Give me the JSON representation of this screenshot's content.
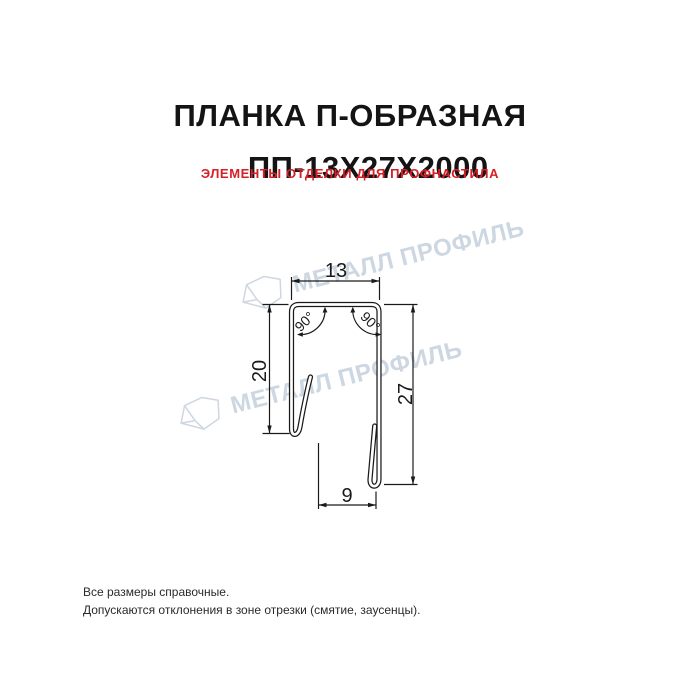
{
  "header": {
    "title_line1": "ПЛАНКА П-ОБРАЗНАЯ",
    "title_line2": "ПП-13Х27Х2000",
    "subtitle": "ЭЛЕМЕНТЫ ОТДЕЛКИ ДЛЯ ПРОФНАСТИЛА",
    "title_color": "#141414",
    "subtitle_color": "#d52027"
  },
  "watermark": {
    "text": "МЕТАЛЛ ПРОФИЛЬ",
    "color": "#cdd7e2"
  },
  "drawing": {
    "line_color": "#1a1a1a",
    "dimensions": {
      "top_width": "13",
      "left_height": "20",
      "right_height": "27",
      "bottom_width": "9",
      "angle_left": "90°",
      "angle_right": "90°"
    }
  },
  "footer": {
    "note1": "Все размеры справочные.",
    "note2": "Допускаются отклонения в зоне отрезки (смятие, заусенцы)."
  }
}
